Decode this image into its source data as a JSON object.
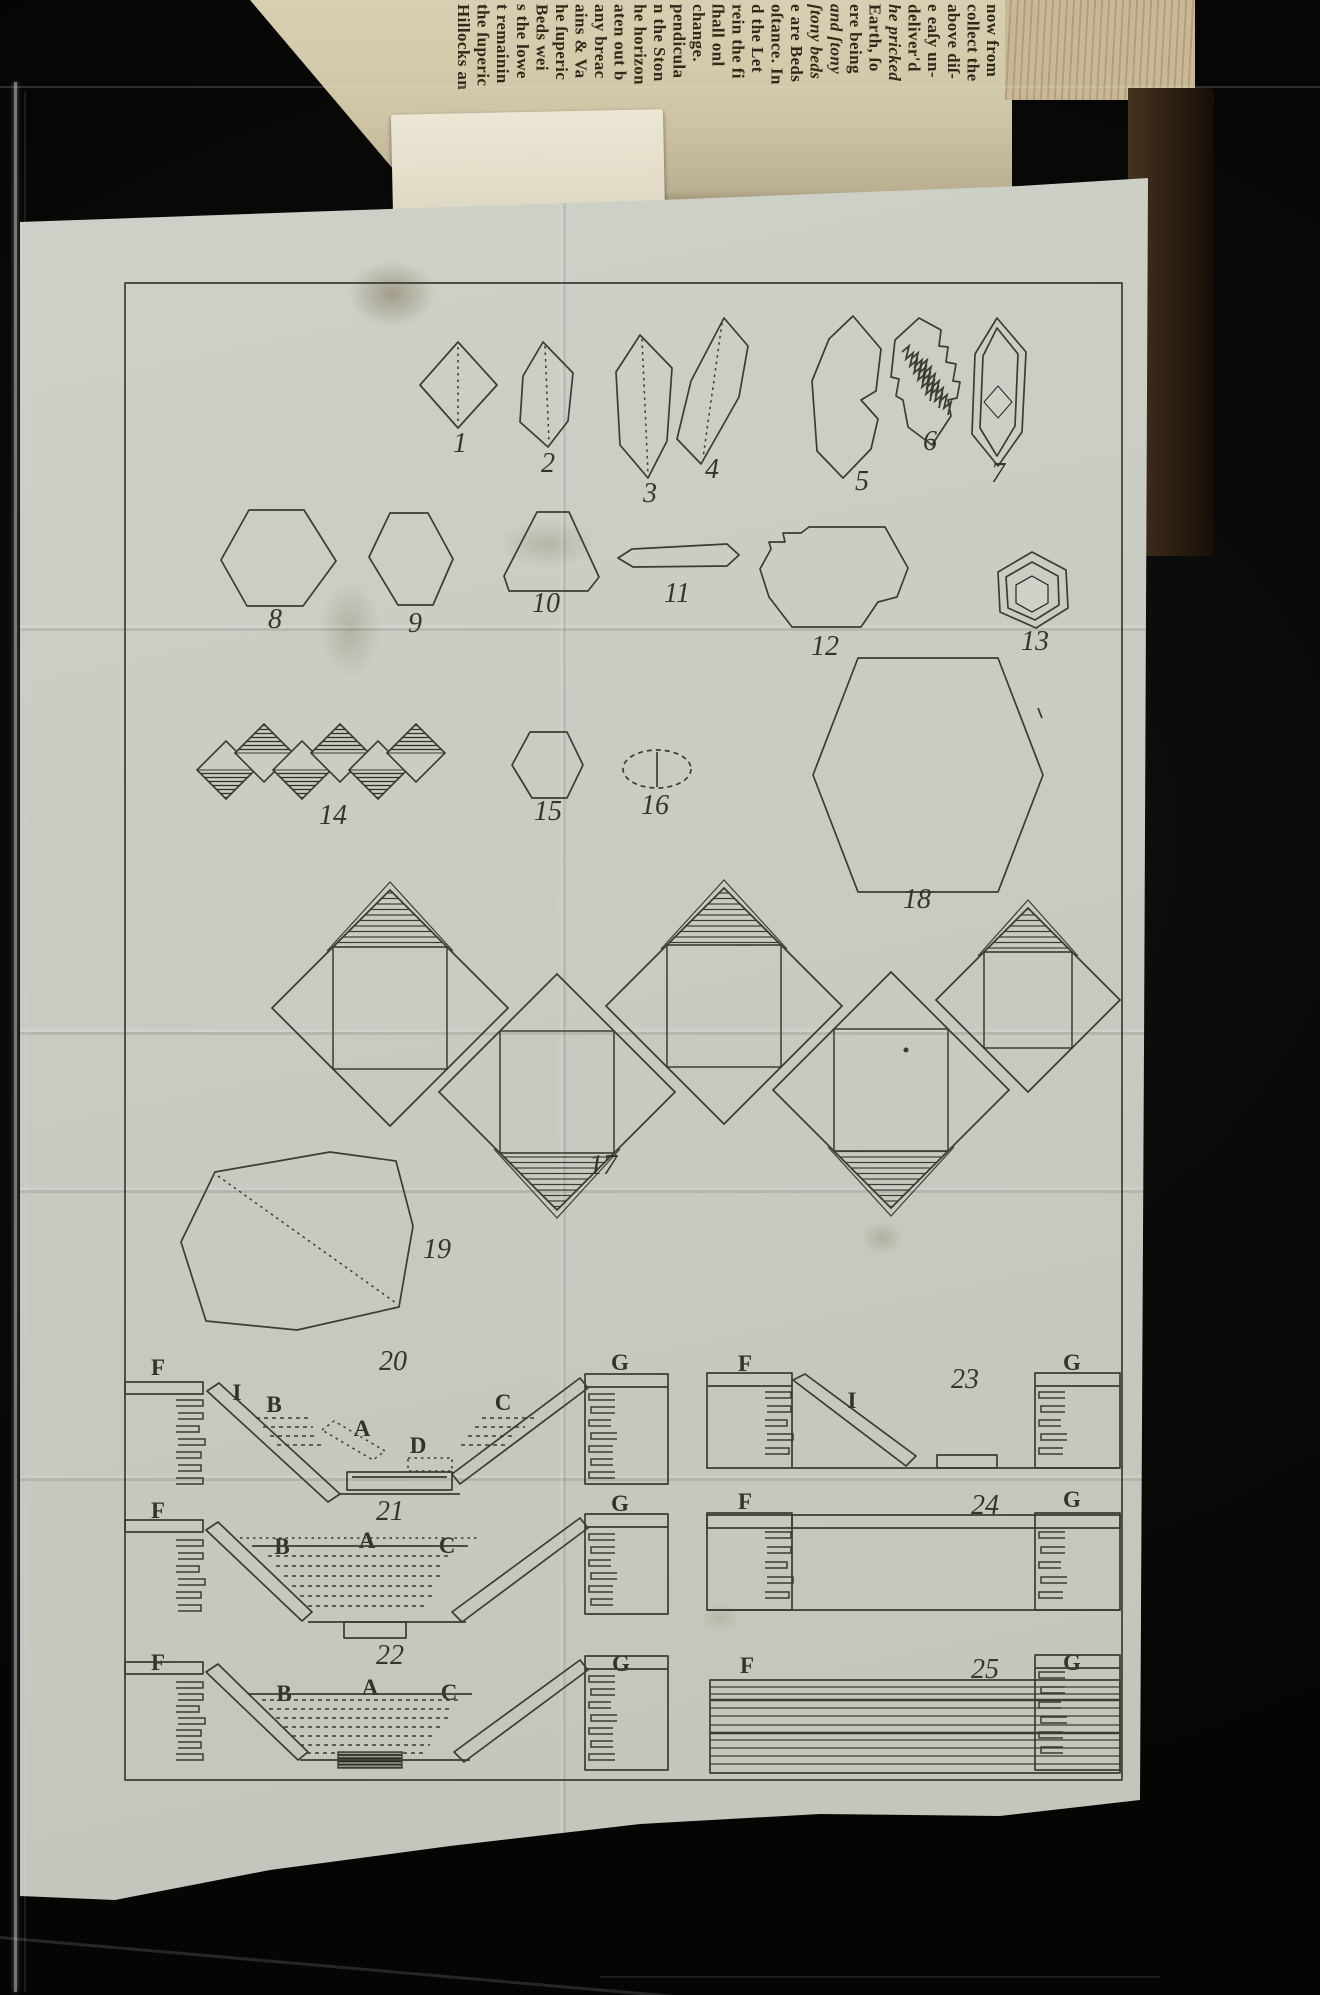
{
  "photo": {
    "background": "#0a0a09",
    "plate_paper": "#c8ccc2",
    "book_paper": "#cfc5a6",
    "ink": "#3b3c33",
    "cover_leather": "#2a1d10"
  },
  "book_text": [
    "now from",
    "collect the",
    "above diſ-",
    "e eaſy un-",
    "deliver'd",
    "he pricked",
    "Earth, ſo",
    "ere being",
    "and ſtony",
    "ſtony beds",
    "e are Beds",
    "oſtance. In",
    "d the Let",
    "rein the fi",
    "ſhall onl",
    "change.",
    "pendicula",
    "n the Ston",
    "he horizon",
    "aten out b",
    "any breac",
    "ains & Va",
    "he ſuperic",
    "Beds wei",
    "s the lowe",
    "t remainin",
    "the ſuperic",
    "Hillocks an"
  ],
  "labels": {
    "n1": "1",
    "n2": "2",
    "n3": "3",
    "n4": "4",
    "n5": "5",
    "n6": "6",
    "n7": "7",
    "n8": "8",
    "n9": "9",
    "n10": "10",
    "n11": "11",
    "n12": "12",
    "n13": "13",
    "n14": "14",
    "n15": "15",
    "n16": "16",
    "n17": "17",
    "n18": "18",
    "n19": "19",
    "n20": "20",
    "n21": "21",
    "n22": "22",
    "n23": "23",
    "n24": "24",
    "n25": "25",
    "f": "F",
    "g": "G",
    "i": "I",
    "a": "A",
    "b": "B",
    "c": "C",
    "d": "D"
  }
}
